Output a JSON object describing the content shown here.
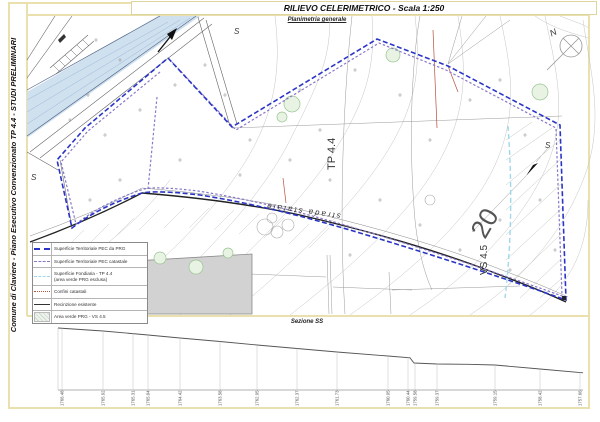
{
  "page": {
    "title": "RILIEVO CELERIMETRICO - Scala 1:250",
    "sidebar_title": "Comune di Claviere - Piano Esecutivo Convenzionato TP 4.4 - STUDI PRELIMINARI",
    "map_caption": "Planimetria generale"
  },
  "map": {
    "labels": {
      "parcel_tp": "TP 4.4",
      "parcel_number": "20",
      "green_area": "VS 4.5",
      "road": "strada statale",
      "north": "N",
      "station": "S"
    }
  },
  "legend": {
    "items": [
      {
        "label": "Superficie Territoriale PEC  da PRG"
      },
      {
        "label": "Superficie Territoriale PEC catastale"
      },
      {
        "label": "Superficie Fondiaria - TP 4.4",
        "label2": "(area verde PRG esclusa)"
      },
      {
        "label": "Confini catastali"
      },
      {
        "label": "Recinzione esistente"
      },
      {
        "label": "Area verde PRG - VS 4.5"
      }
    ]
  },
  "section": {
    "label": "Sezione SS",
    "elevations": [
      "1766.48",
      "1765.92",
      "1765.31",
      "1765.04",
      "1764.42",
      "1763.58",
      "1762.95",
      "1762.37",
      "1761.73",
      "1760.95",
      "1760.44",
      "1759.58",
      "1759.37",
      "1759.15",
      "1758.42",
      "1757.66"
    ]
  },
  "colors": {
    "frame": "#e9e0ad",
    "pec_prg": "#2a35c8",
    "pec_catastale": "#8878c8",
    "fondiaria": "#9fd8ec",
    "confini": "#b5503a",
    "river": "#cfe0ef",
    "building": "#d2d2d2"
  }
}
